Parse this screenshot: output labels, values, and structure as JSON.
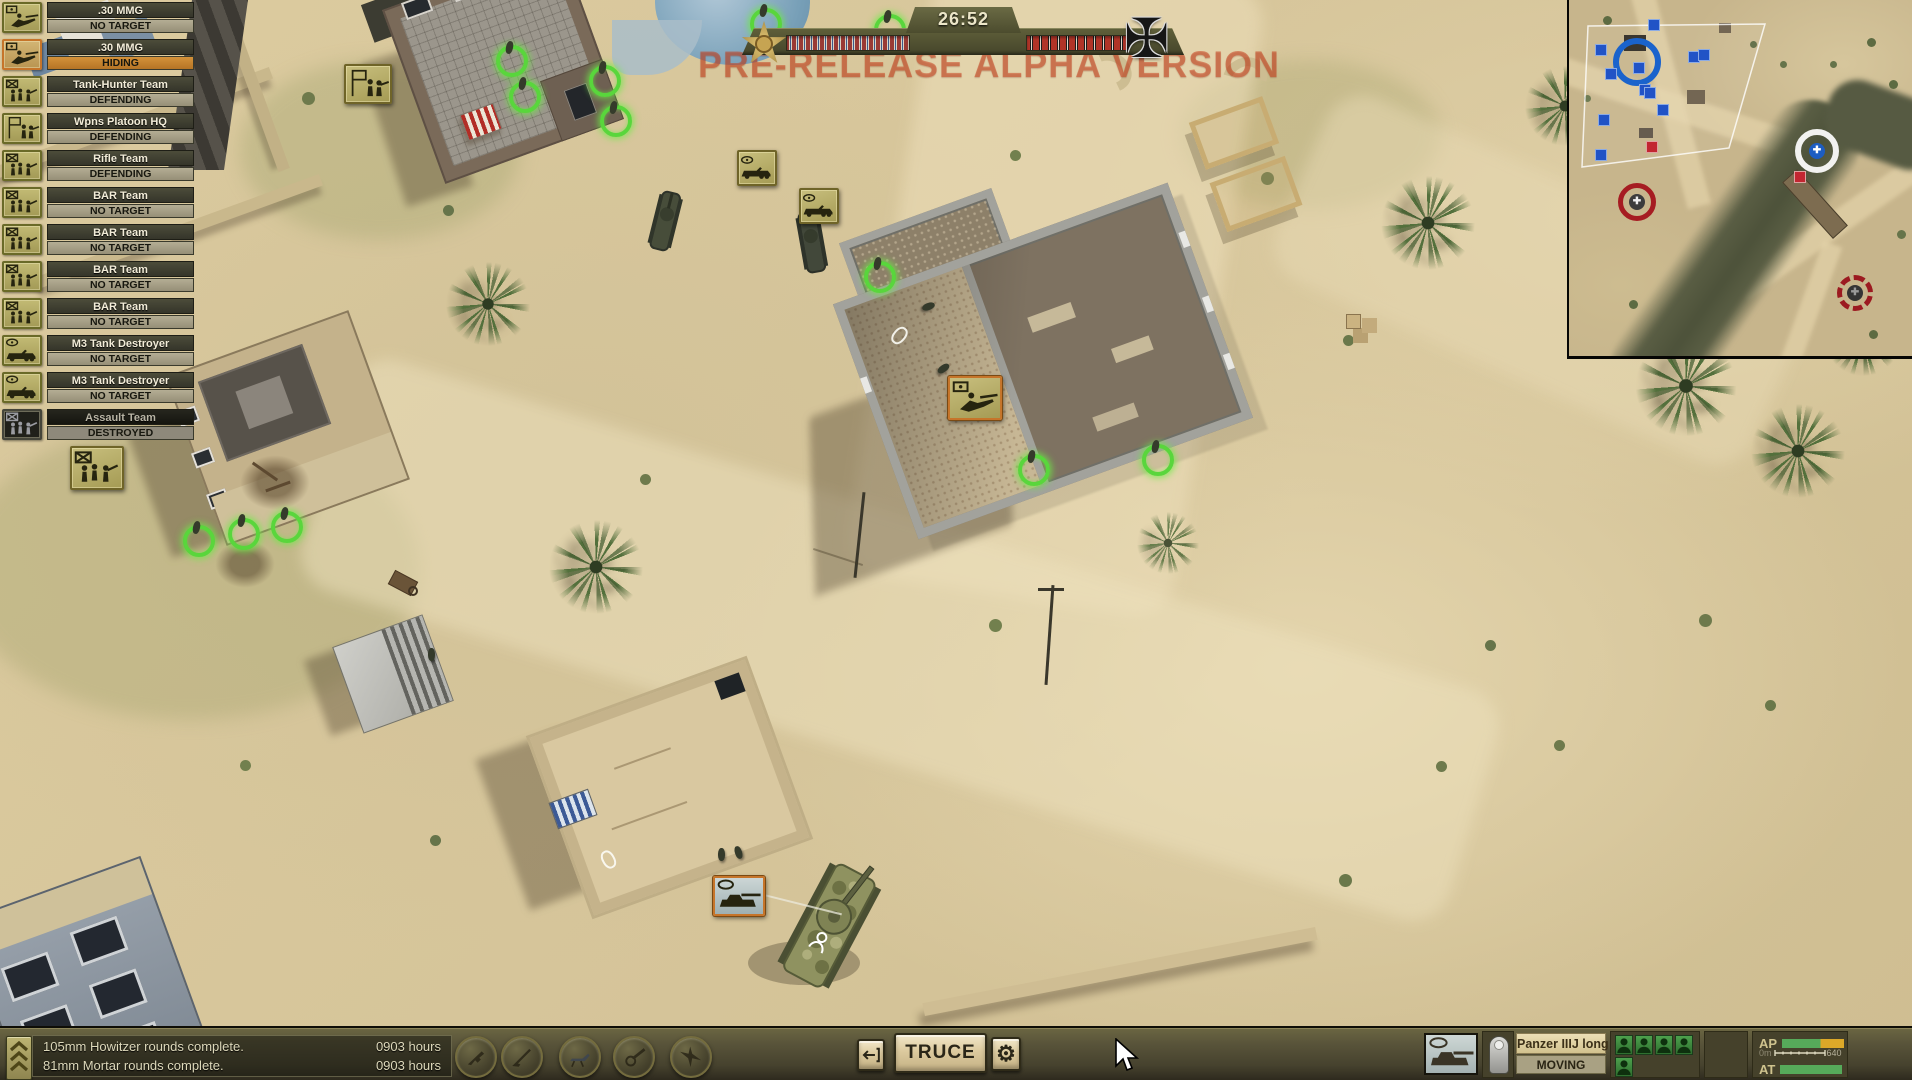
{
  "watermark": "PRE-RELEASE ALPHA VERSION",
  "top_bar": {
    "timer": "26:52"
  },
  "unit_list": [
    {
      "name": ".30 MMG",
      "status": "NO TARGET",
      "icon": "mmg",
      "state": "normal"
    },
    {
      "name": ".30 MMG",
      "status": "HIDING",
      "icon": "mmg",
      "state": "selected"
    },
    {
      "name": "Tank-Hunter Team",
      "status": "DEFENDING",
      "icon": "team",
      "state": "normal"
    },
    {
      "name": "Wpns Platoon HQ",
      "status": "DEFENDING",
      "icon": "hq",
      "state": "normal"
    },
    {
      "name": "Rifle Team",
      "status": "DEFENDING",
      "icon": "team",
      "state": "normal"
    },
    {
      "name": "BAR Team",
      "status": "NO TARGET",
      "icon": "team",
      "state": "normal"
    },
    {
      "name": "BAR Team",
      "status": "NO TARGET",
      "icon": "team",
      "state": "normal"
    },
    {
      "name": "BAR Team",
      "status": "NO TARGET",
      "icon": "team",
      "state": "normal"
    },
    {
      "name": "BAR Team",
      "status": "NO TARGET",
      "icon": "team",
      "state": "normal"
    },
    {
      "name": "M3 Tank Destroyer",
      "status": "NO TARGET",
      "icon": "vehicle",
      "state": "normal"
    },
    {
      "name": "M3 Tank Destroyer",
      "status": "NO TARGET",
      "icon": "vehicle",
      "state": "normal"
    },
    {
      "name": "Assault Team",
      "status": "DESTROYED",
      "icon": "team",
      "state": "destroyed"
    }
  ],
  "messages": [
    {
      "text": "105mm Howitzer rounds complete.",
      "time": "0903 hours"
    },
    {
      "text": "81mm Mortar rounds complete.",
      "time": "0903 hours"
    }
  ],
  "bottom_bar": {
    "truce_label": "TRUCE",
    "gear_icon": "⚙",
    "selected_unit": {
      "name": "Panzer IIIJ long",
      "status": "MOVING",
      "crew": 5
    },
    "ammo": {
      "ap_label": "AP",
      "at_label": "AT",
      "range_start": "0m",
      "range_end": "640"
    }
  },
  "map_icons": [
    {
      "type": "hq",
      "x": 344,
      "y": 64,
      "selected": false
    },
    {
      "type": "vehicle",
      "x": 737,
      "y": 150,
      "selected": false
    },
    {
      "type": "vehicle",
      "x": 799,
      "y": 188,
      "selected": false
    },
    {
      "type": "mmg",
      "x": 948,
      "y": 376,
      "selected": true
    },
    {
      "type": "tank",
      "x": 713,
      "y": 876,
      "selected": true
    },
    {
      "type": "team",
      "x": 70,
      "y": 446,
      "selected": false
    }
  ],
  "selection_rings": [
    [
      508,
      57
    ],
    [
      521,
      93
    ],
    [
      601,
      77
    ],
    [
      612,
      117
    ],
    [
      876,
      273
    ],
    [
      1030,
      466
    ],
    [
      1154,
      456
    ],
    [
      762,
      20
    ],
    [
      886,
      26
    ],
    [
      195,
      537
    ],
    [
      240,
      530
    ],
    [
      283,
      523
    ],
    [
      1805,
      12
    ],
    [
      1868,
      28
    ]
  ],
  "minimap": {
    "friendly_squares": [
      [
        85,
        25
      ],
      [
        32,
        50
      ],
      [
        125,
        57
      ],
      [
        135,
        55
      ],
      [
        70,
        68
      ],
      [
        42,
        74
      ],
      [
        76,
        90
      ],
      [
        81,
        93
      ],
      [
        94,
        110
      ],
      [
        35,
        120
      ],
      [
        32,
        155
      ]
    ],
    "enemy_squares": [
      [
        83,
        147
      ],
      [
        231,
        177
      ]
    ],
    "objectives": [
      {
        "type": "blue-ring",
        "x": 68,
        "y": 62
      },
      {
        "type": "white-ring",
        "x": 248,
        "y": 151
      },
      {
        "type": "red-ring",
        "x": 68,
        "y": 202
      },
      {
        "type": "red-ring-broken",
        "x": 286,
        "y": 293
      }
    ]
  },
  "colors": {
    "selection_green": "#59d63c",
    "highlight_orange": "#c6752a",
    "friendly_blue": "#2153c6",
    "enemy_red": "#c22631"
  }
}
